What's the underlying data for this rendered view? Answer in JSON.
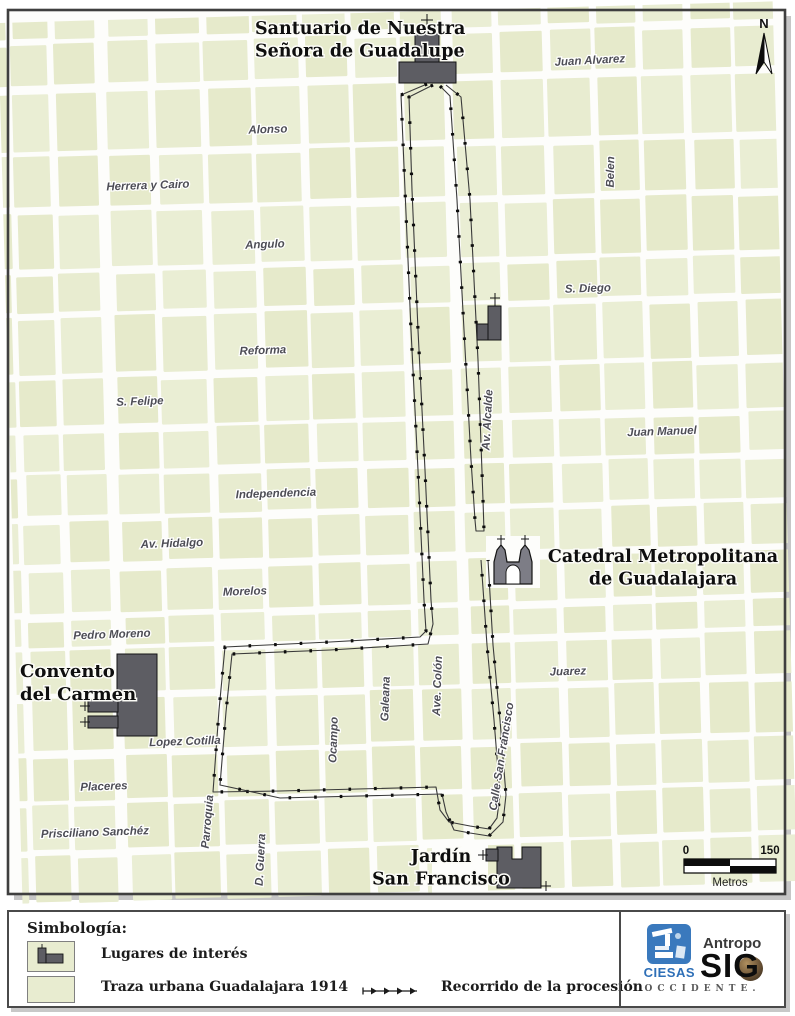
{
  "map": {
    "north_label": "N",
    "scale_bar": {
      "start": "0",
      "end": "150",
      "unit": "Metros"
    },
    "landmarks": [
      {
        "id": "santuario",
        "name": "Santuario de Nuestra Señora de Guadalupe",
        "lines": [
          "Santuario de Nuestra",
          "Señora de Guadalupe"
        ],
        "x": 255,
        "y": 34,
        "anchor": "start",
        "size": 17.5
      },
      {
        "id": "catedral",
        "name": "Catedral Metropolitana de Guadalajara",
        "lines": [
          "Catedral Metropolitana",
          "de Guadalajara"
        ],
        "x": 663,
        "y": 562,
        "anchor": "middle",
        "size": 17.5
      },
      {
        "id": "convento",
        "name": "Convento del Carmen",
        "lines": [
          "Convento",
          "del Carmen"
        ],
        "x": 20,
        "y": 677,
        "anchor": "start",
        "size": 18
      },
      {
        "id": "jardin",
        "name": "Jardín San Francisco",
        "lines": [
          "Jardín",
          "San Francisco"
        ],
        "x": 441,
        "y": 862,
        "anchor": "middle",
        "size": 17.5
      }
    ],
    "street_labels": [
      {
        "name": "Juan Alvarez",
        "x": 590,
        "y": 64,
        "rotate": -3
      },
      {
        "name": "Alonso",
        "x": 268,
        "y": 133,
        "rotate": -2
      },
      {
        "name": "Herrera y Cairo",
        "x": 148,
        "y": 189,
        "rotate": -2
      },
      {
        "name": "Angulo",
        "x": 265,
        "y": 248,
        "rotate": -2
      },
      {
        "name": "S. Diego",
        "x": 588,
        "y": 292,
        "rotate": -2
      },
      {
        "name": "Reforma",
        "x": 263,
        "y": 354,
        "rotate": -2
      },
      {
        "name": "S. Felipe",
        "x": 140,
        "y": 405,
        "rotate": -2
      },
      {
        "name": "Juan Manuel",
        "x": 662,
        "y": 435,
        "rotate": -2
      },
      {
        "name": "Independencia",
        "x": 276,
        "y": 497,
        "rotate": -2
      },
      {
        "name": "Av. Hidalgo",
        "x": 172,
        "y": 547,
        "rotate": -2
      },
      {
        "name": "Morelos",
        "x": 245,
        "y": 595,
        "rotate": -2
      },
      {
        "name": "Pedro Moreno",
        "x": 112,
        "y": 638,
        "rotate": -2
      },
      {
        "name": "Juarez",
        "x": 568,
        "y": 675,
        "rotate": -2
      },
      {
        "name": "Lopez Cotilla",
        "x": 185,
        "y": 745,
        "rotate": -2
      },
      {
        "name": "Placeres",
        "x": 104,
        "y": 790,
        "rotate": -2
      },
      {
        "name": "Prisciliano Sanchéz",
        "x": 95,
        "y": 836,
        "rotate": -2
      },
      {
        "name": "Belen",
        "x": 614,
        "y": 172,
        "rotate": -89
      },
      {
        "name": "Av. Alcalde",
        "x": 491,
        "y": 420,
        "rotate": -87
      },
      {
        "name": "Ave. Colón",
        "x": 441,
        "y": 686,
        "rotate": -88
      },
      {
        "name": "Galeana",
        "x": 389,
        "y": 699,
        "rotate": -88
      },
      {
        "name": "Ocampo",
        "x": 337,
        "y": 740,
        "rotate": -88
      },
      {
        "name": "Parroquia",
        "x": 211,
        "y": 822,
        "rotate": -85
      },
      {
        "name": "D. Guerra",
        "x": 264,
        "y": 860,
        "rotate": -87
      },
      {
        "name": "Calle San Francisco",
        "x": 505,
        "y": 757,
        "rotate": -81
      }
    ]
  },
  "legend": {
    "title": "Simbología:",
    "items": [
      {
        "symbol": "places-of-interest",
        "label": "Lugares de interés"
      },
      {
        "symbol": "urban-grid-swatch",
        "label": "Traza urbana Guadalajara 1914"
      },
      {
        "symbol": "route-line",
        "label": "Recorrido de la procesión"
      }
    ]
  },
  "logo": {
    "org": "CIESAS",
    "product_line1": "Antropo",
    "product_line2": "SIG",
    "region": "OCCIDENTE."
  },
  "colors": {
    "block_fill": "#e8ecd0",
    "street": "#ffffff",
    "building": "#5d5d63",
    "catedral_fill": "#7d7d86",
    "route": "#2e2e2e",
    "frame": "#3f3f3f",
    "street_label": "#4d4d55",
    "ciesas_blue": "#2e6fb7"
  }
}
